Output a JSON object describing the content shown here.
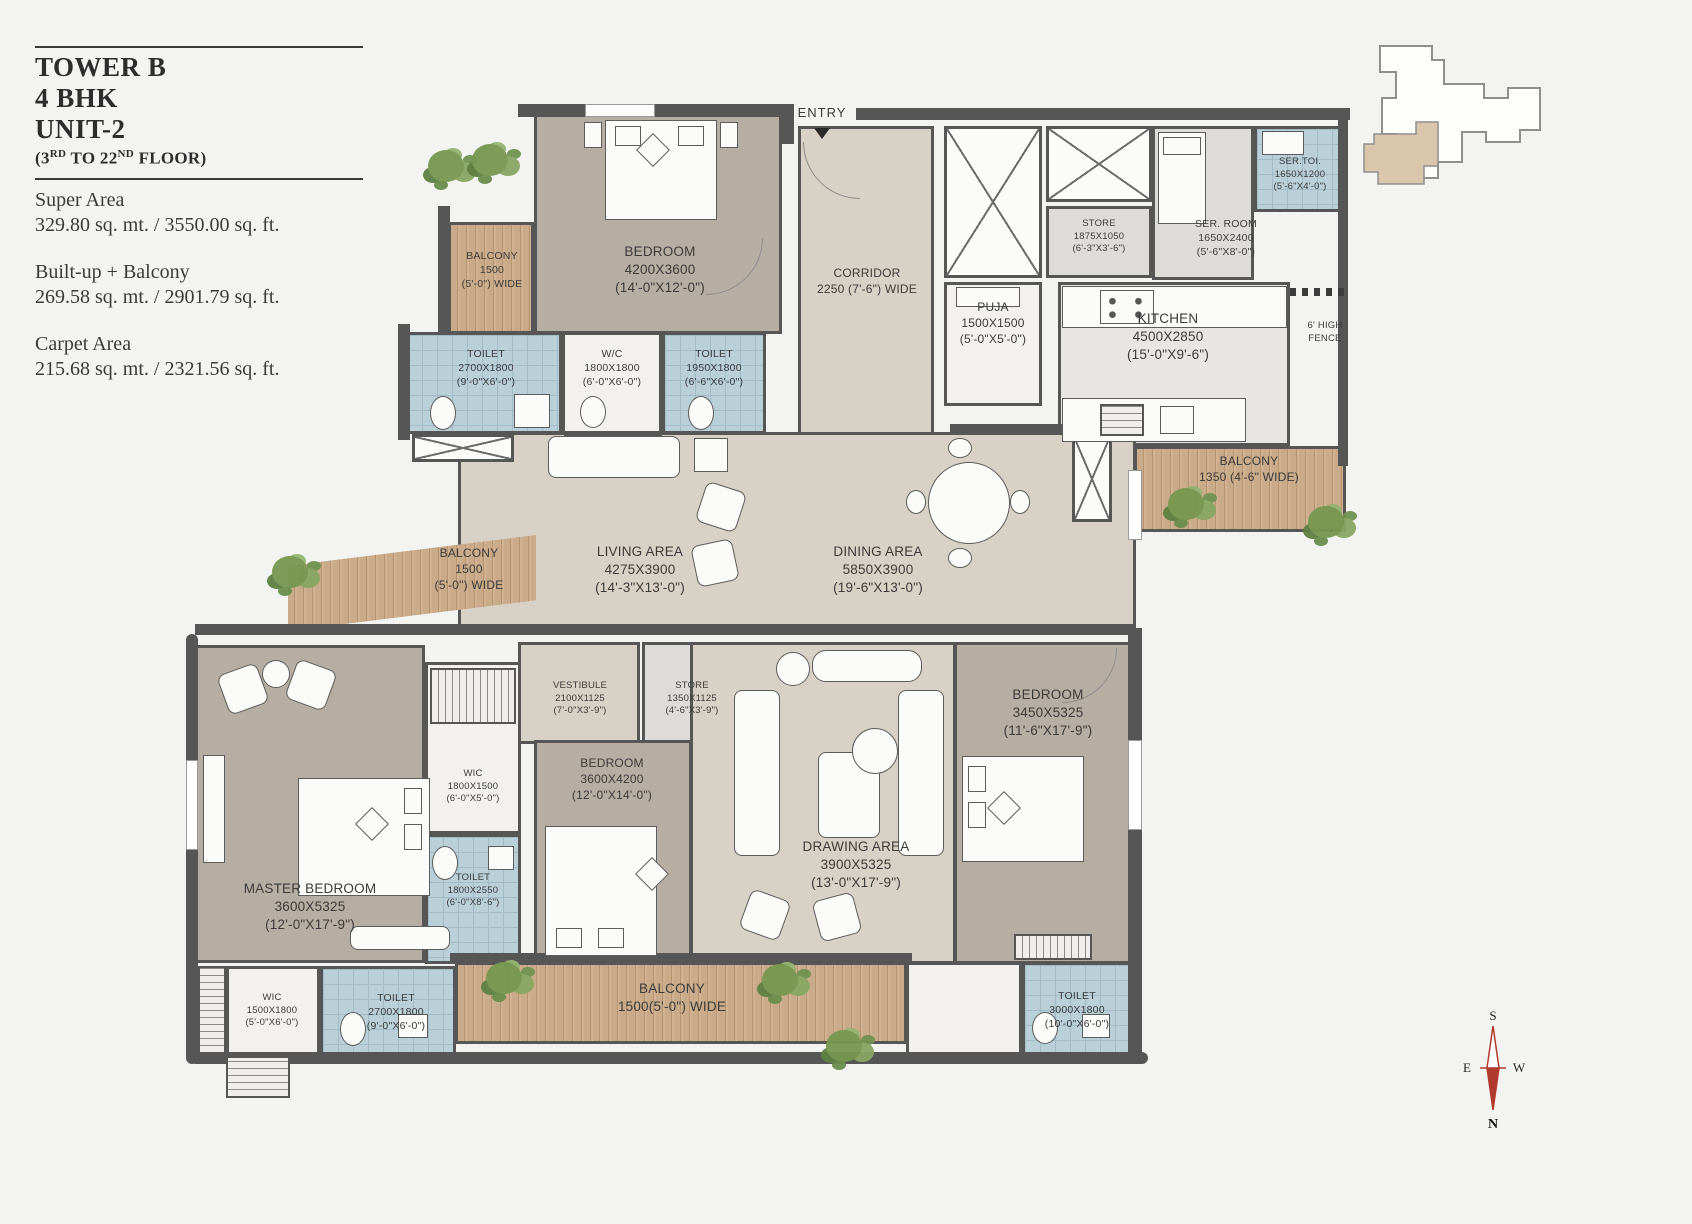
{
  "title_block": {
    "tower": "TOWER B",
    "bhk": "4 BHK",
    "unit": "UNIT-2",
    "floors": {
      "p1": "(3",
      "sup1": "RD",
      "p2": " TO 22",
      "sup2": "ND",
      "p3": " FLOOR)"
    },
    "areas": [
      {
        "label": "Super Area",
        "value": "329.80 sq. mt. / 3550.00 sq. ft."
      },
      {
        "label": "Built-up + Balcony",
        "value": "269.58 sq. mt. / 2901.79 sq. ft."
      },
      {
        "label": "Carpet Area",
        "value": "215.68 sq. mt. / 2321.56 sq. ft."
      }
    ]
  },
  "entry": "ENTRY",
  "fence": {
    "l1": "6' HIGH",
    "l2": "FENCE"
  },
  "compass": {
    "n": "N",
    "s": "S",
    "e": "E",
    "w": "W"
  },
  "colors": {
    "wall": "#565656",
    "bedroom_floor": "#b6ada3",
    "living_floor": "#d8d1c5",
    "toilet_tile": "#bad0d8",
    "balcony_wood": "#c9aa89",
    "keyplan_unit": "#d9c6ab",
    "compass_needle": "#b03a2e"
  },
  "rooms": {
    "balcony_tl": {
      "name": "BALCONY",
      "dim": "1500",
      "ft": "(5'-0\") WIDE"
    },
    "bedroom_top": {
      "name": "BEDROOM",
      "dim": "4200X3600",
      "ft": "(14'-0\"X12'-0\")"
    },
    "toilet_a": {
      "name": "TOILET",
      "dim": "2700X1800",
      "ft": "(9'-0\"X6'-0\")"
    },
    "wc": {
      "name": "W/C",
      "dim": "1800X1800",
      "ft": "(6'-0\"X6'-0\")"
    },
    "toilet_b": {
      "name": "TOILET",
      "dim": "1950X1800",
      "ft": "(6'-6\"X6'-0\")"
    },
    "corridor": {
      "name": "CORRIDOR",
      "dim": "2250 (7'-6\") WIDE"
    },
    "puja": {
      "name": "PUJA",
      "dim": "1500X1500",
      "ft": "(5'-0\"X5'-0\")"
    },
    "store_top": {
      "name": "STORE",
      "dim": "1875X1050",
      "ft": "(6'-3\"X3'-6\")"
    },
    "ser_room": {
      "name": "SER. ROOM",
      "dim": "1650X2400",
      "ft": "(5'-6\"X8'-0\")"
    },
    "ser_toi": {
      "name": "SER.TOI.",
      "dim": "1650X1200",
      "ft": "(5'-6\"X4'-0\")"
    },
    "kitchen": {
      "name": "KITCHEN",
      "dim": "4500X2850",
      "ft": "(15'-0\"X9'-6\")"
    },
    "balcony_right": {
      "name": "BALCONY",
      "dim": "1350 (4'-6\" WIDE)"
    },
    "balcony_left": {
      "name": "BALCONY",
      "dim": "1500",
      "ft": "(5'-0\") WIDE"
    },
    "living": {
      "name": "LIVING AREA",
      "dim": "4275X3900",
      "ft": "(14'-3\"X13'-0\")"
    },
    "dining": {
      "name": "DINING AREA",
      "dim": "5850X3900",
      "ft": "(19'-6\"X13'-0\")"
    },
    "vestibule": {
      "name": "VESTIBULE",
      "dim": "2100X1125",
      "ft": "(7'-0\"X3'-9\")"
    },
    "store_mid": {
      "name": "STORE",
      "dim": "1350X1125",
      "ft": "(4'-6\"X3'-9\")"
    },
    "master": {
      "name": "MASTER BEDROOM",
      "dim": "3600X5325",
      "ft": "(12'-0\"X17'-9\")"
    },
    "wic_master": {
      "name": "WIC",
      "dim": "1800X1500",
      "ft": "(6'-0\"X5'-0\")"
    },
    "toilet_master": {
      "name": "TOILET",
      "dim": "1800X2550",
      "ft": "(6'-0\"X8'-6\")"
    },
    "bedroom_mid": {
      "name": "BEDROOM",
      "dim": "3600X4200",
      "ft": "(12'-0\"X14'-0\")"
    },
    "drawing": {
      "name": "DRAWING AREA",
      "dim": "3900X5325",
      "ft": "(13'-0\"X17'-9\")"
    },
    "bedroom_right": {
      "name": "BEDROOM",
      "dim": "3450X5325",
      "ft": "(11'-6\"X17'-9\")"
    },
    "wic_bl": {
      "name": "WIC",
      "dim": "1500X1800",
      "ft": "(5'-0\"X6'-0\")"
    },
    "toilet_bl": {
      "name": "TOILET",
      "dim": "2700X1800",
      "ft": "(9'-0\"X6'-0\")"
    },
    "balcony_bottom": {
      "name": "BALCONY",
      "dim": "1500(5'-0\") WIDE"
    },
    "toilet_br": {
      "name": "TOILET",
      "dim": "3000X1800",
      "ft": "(10'-0\"X6'-0\")"
    }
  }
}
